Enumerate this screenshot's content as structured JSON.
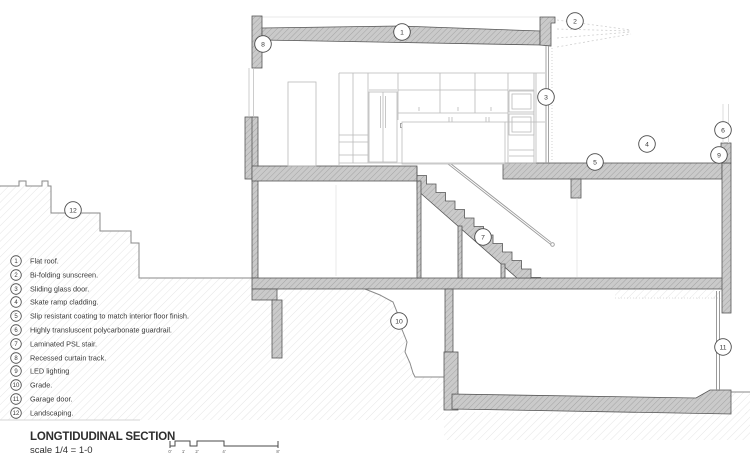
{
  "titleblock": {
    "title": "LONGTIDUDINAL SECTION",
    "scale": "scale 1/4 = 1-0"
  },
  "legend": {
    "items": [
      {
        "num": "1",
        "label": "Flat roof."
      },
      {
        "num": "2",
        "label": "Bi-folding sunscreen."
      },
      {
        "num": "3",
        "label": "Sliding glass door."
      },
      {
        "num": "4",
        "label": "Skate ramp cladding."
      },
      {
        "num": "5",
        "label": "Slip resistant coating to match interior floor finish."
      },
      {
        "num": "6",
        "label": "Highly transluscent polycarbonate guardrail."
      },
      {
        "num": "7",
        "label": "Laminated PSL stair."
      },
      {
        "num": "8",
        "label": "Recessed curtain track."
      },
      {
        "num": "9",
        "label": "LED lighting"
      },
      {
        "num": "10",
        "label": "Grade."
      },
      {
        "num": "11",
        "label": "Garage door."
      },
      {
        "num": "12",
        "label": "Landscaping."
      }
    ]
  },
  "callouts": [
    "1",
    "2",
    "3",
    "4",
    "5",
    "6",
    "7",
    "8",
    "9",
    "10",
    "11",
    "12"
  ],
  "scale_bar": {
    "labels": [
      "0'",
      "1'",
      "2'",
      "4'",
      "8'"
    ]
  },
  "colors": {
    "wall_fill": "#cacaca",
    "wall_hatch_line": "#9b9b9b",
    "earth_hatch_line": "#e0e0e0",
    "outline": "#565656",
    "text": "#3a3a3a",
    "background": "#ffffff"
  }
}
